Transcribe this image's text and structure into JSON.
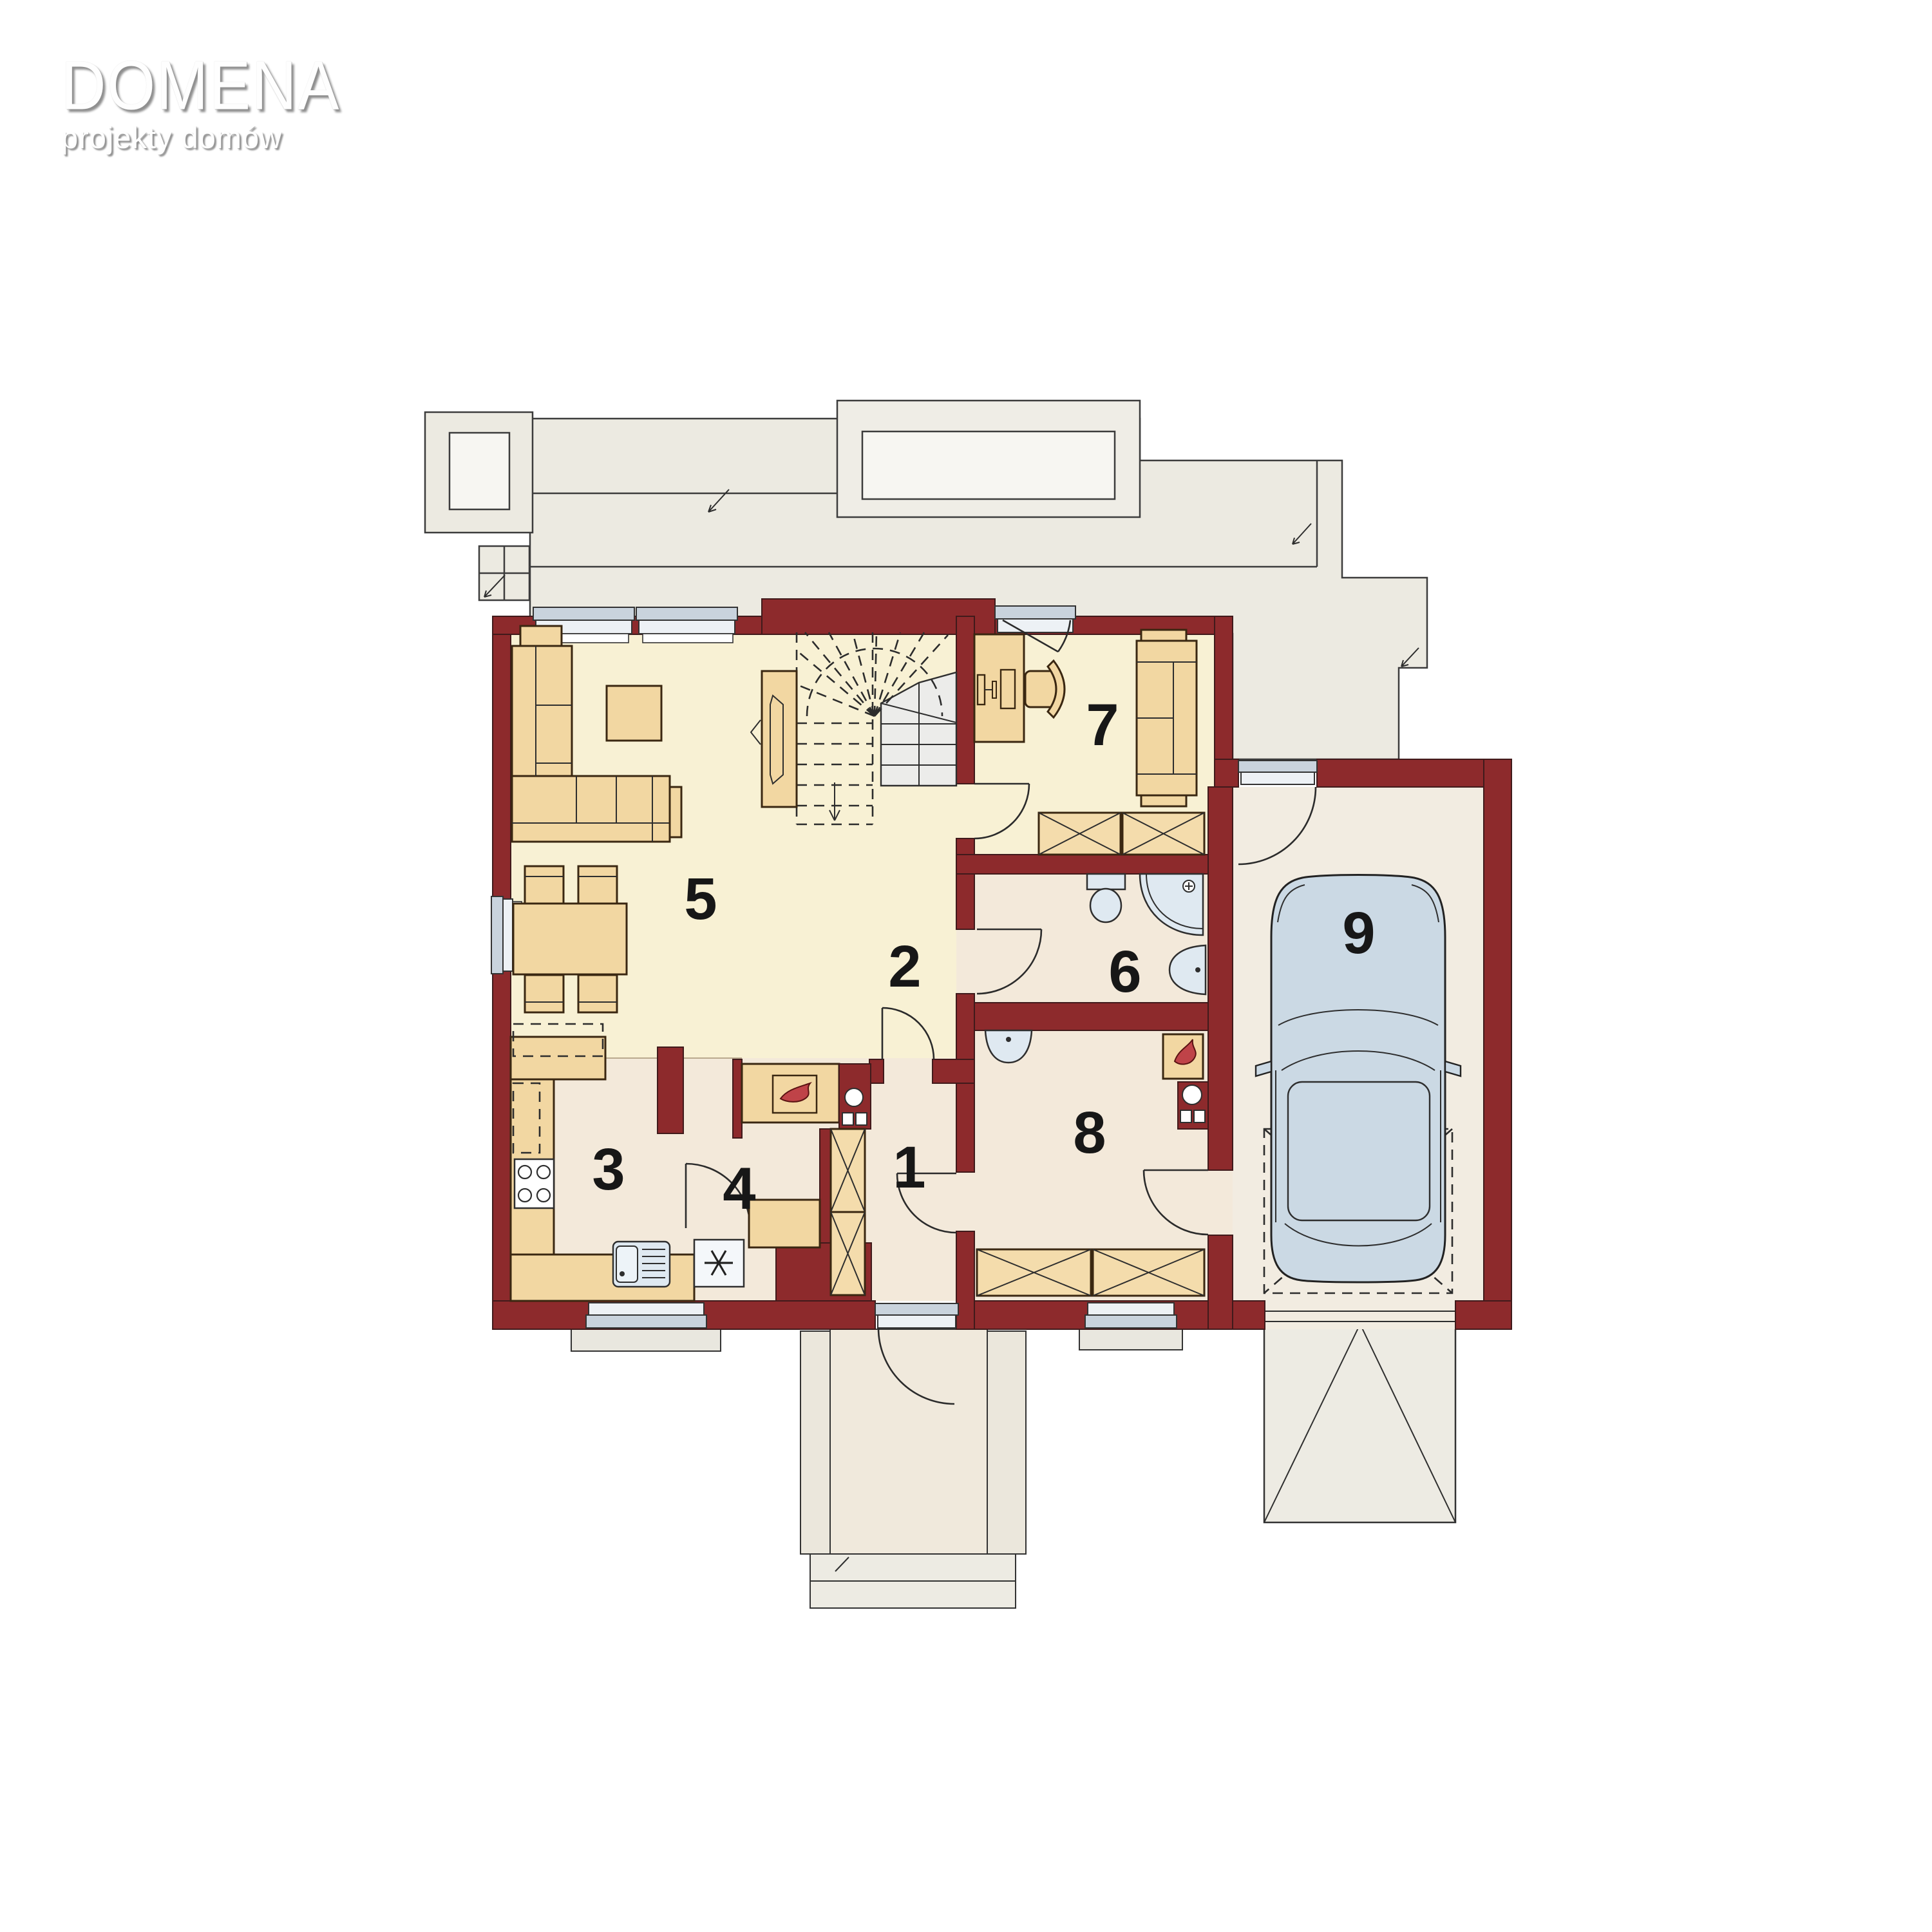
{
  "logo": {
    "title": "DOMENA",
    "tagline": "projekty domów"
  },
  "room_labels": [
    "1",
    "2",
    "3",
    "4",
    "5",
    "6",
    "7",
    "8",
    "9"
  ],
  "icons": {
    "freezer": "six-spoke asterisk",
    "fireplace_flame": "flame",
    "boiler_flame": "flame",
    "car": "car-top-view"
  },
  "colors": {
    "wall": "#8D2A2C",
    "floor_day_zone": "#F8F1D4",
    "floor_service_zone": "#F3E9DA",
    "floor_garage": "#F2ECE1",
    "terrace": "#ECEAE1",
    "furniture": "#F2D7A2",
    "fixtures": "#DFE9F1",
    "flame": "#BF4348",
    "car": "#CBD9E4"
  }
}
